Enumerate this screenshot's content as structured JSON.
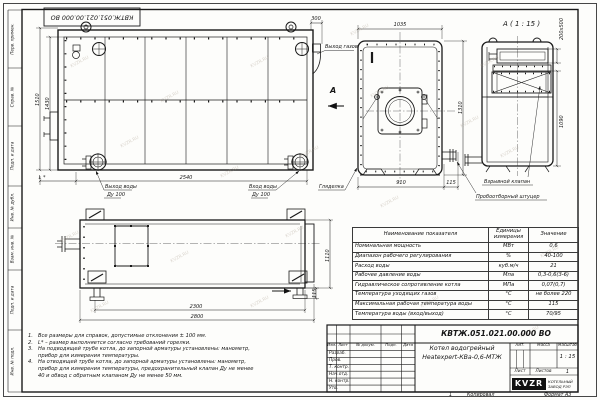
{
  "frame": {
    "top_stamp": "КВТЖ.051.021.00.000 ВО",
    "left_stamps": [
      "Перв. примен.",
      "Справ. №",
      "Подп. и дата",
      "Инв. № дубл.",
      "Взам. инв. №",
      "Подп. и дата",
      "Инв. № подл."
    ],
    "bottom": {
      "sheet_num": "1",
      "copied": "Копировал",
      "format": "Формат А3"
    },
    "watermark": "KVZR.RU"
  },
  "side_view": {
    "dim_1510": "1510",
    "dim_1430": "1430",
    "dim_2540": "2540",
    "dim_L": "L *",
    "dim_300": "300",
    "callout_gas_out": "Выход газов",
    "callout_water_out_1": "Выход воды",
    "callout_water_out_2": "Ду 100",
    "callout_water_in_1": "Вход воды",
    "callout_water_in_2": "Ду 100",
    "callout_sight": "Гляделка",
    "section_letter": "А"
  },
  "front_view": {
    "dim_1035": "1035",
    "dim_910": "910",
    "dim_115": "115",
    "dim_1310": "1310"
  },
  "detail_view": {
    "title": "А ( 1 : 15 )",
    "dim_200x500": "200х500",
    "dim_1090": "1090",
    "callout_explosion_valve": "Взрывной клапан",
    "callout_sampling": "Пробоотборный штуцер"
  },
  "top_view": {
    "dim_2300": "2300",
    "dim_2800": "2800",
    "dim_1110": "1110",
    "dim_115": "115"
  },
  "spec_table": {
    "headers": [
      "Наименование показателя",
      "Единицы измерения",
      "Значение"
    ],
    "rows": [
      [
        "Номинальная мощность",
        "МВт",
        "0,6"
      ],
      [
        "Диапазон рабочего регулирования",
        "%",
        "40-100"
      ],
      [
        "Расход воды",
        "куб.м/ч",
        "21"
      ],
      [
        "Рабочее давление воды",
        "Мпа",
        "0,3-0,6(3-6)"
      ],
      [
        "Гидравлическое сопротивление котла",
        "МПа",
        "0,07(0,7)"
      ],
      [
        "Температура уходящих газов",
        "°С",
        "не более 220"
      ],
      [
        "Максимальная рабочая температура воды",
        "°С",
        "115"
      ],
      [
        "Температура воды (вход/выход)",
        "°С",
        "70/95"
      ]
    ]
  },
  "notes": {
    "items": [
      {
        "num": "1.",
        "text": "Все размеры для справок, допустимые отклонения ± 100 мм."
      },
      {
        "num": "2.",
        "text": "L* – размер выполняется согласно требований горелки."
      },
      {
        "num": "3.",
        "text": "На подводящей трубе котла, до запорной арматуры установлены: манометр, прибор для измерения температуры."
      },
      {
        "num": "4.",
        "text": "На отводящей трубе котла, до запорной арматуры установлены: манометр, прибор для измерения температуры, предохранительный клапан Ду не менее 40 и обвод с обратным клапаном Ду не менее  50 мм."
      }
    ]
  },
  "title_block": {
    "doc_number": "КВТЖ.051.021.00.000 ВО",
    "product_name_line1": "Котел водогрейный",
    "product_name_line2": "Heatexpert-КВа-0,6-МТЖ",
    "col_headers": [
      "Изм.",
      "Лист",
      "№ докум.",
      "Подп.",
      "Дата"
    ],
    "rows": [
      "Разраб.",
      "Пров.",
      "Т. контр.",
      "Нач.отд.",
      "Н. контр.",
      "Утв."
    ],
    "lit_label": "Лит.",
    "mass_label": "Масса",
    "scale_label": "Масштаб",
    "scale_value": "1 : 15",
    "sheet_label": "Лист",
    "sheets_label": "Листов",
    "sheets_value": "1",
    "logo_text": "KVZR",
    "org_name_line1": "КОТЕЛЬНЫЙ",
    "org_name_line2": "ЗАВОД РЭП"
  }
}
